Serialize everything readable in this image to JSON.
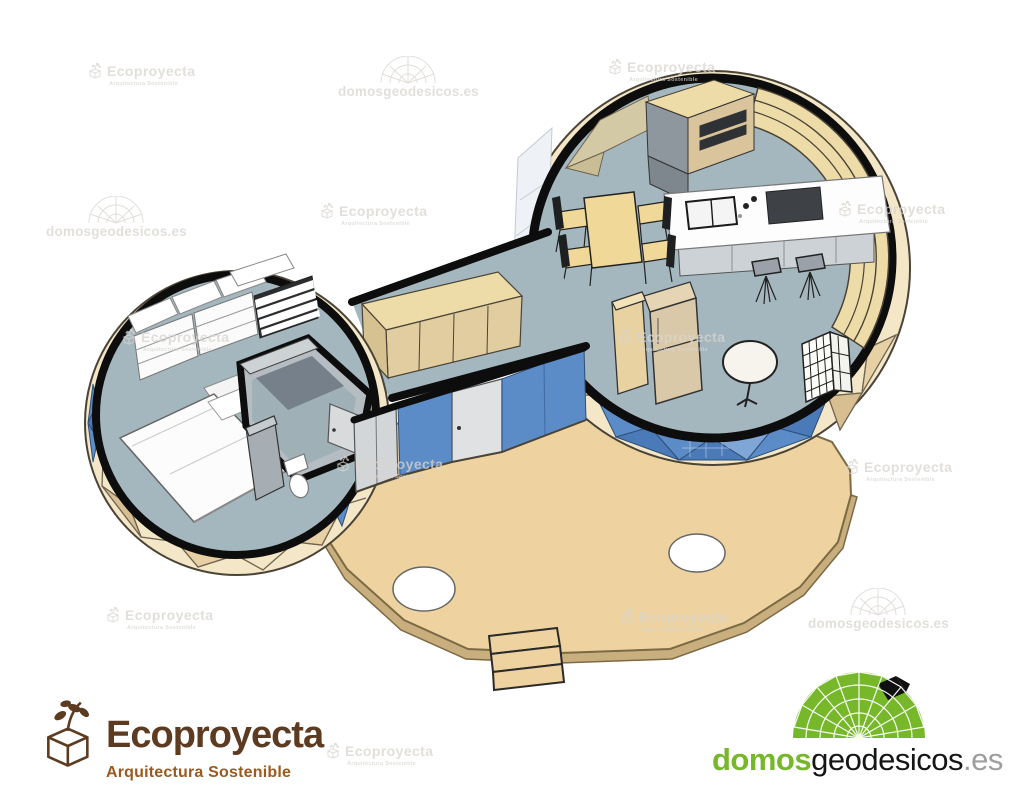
{
  "watermarks": {
    "ecoproyecta_title": "Ecoproyecta",
    "ecoproyecta_subtitle": "Arquitectura Sostenible",
    "domos_text": "domosgeodesicos.es"
  },
  "footer": {
    "eco_title": "Ecoproyecta",
    "eco_subtitle": "Arquitectura Sostenible",
    "domos_part1": "domos",
    "domos_part2": "geodesicos",
    "domos_part3": ".es"
  },
  "colors": {
    "floor": "#a4b7be",
    "shell-cream": "#f3e7c8",
    "shell-tan": "#e6d0a4",
    "shell-dark": "#d8bf92",
    "plywood": "#eedca8",
    "facet": "#6e6450",
    "outline": "#0d0d0d",
    "glass-blue": "#5c8cc7",
    "glass-blue-dark": "#4a7ab8",
    "glass-blue-light": "#7fa6d6",
    "terrace": "#eed3a0",
    "terrace-side": "#c9ae7e",
    "terrace-edge": "#7c6a45",
    "table-wood": "#f0d998",
    "appliance-dark": "#3e4246",
    "wm": "#d9d5cf",
    "eco-brown": "#5d3b20",
    "eco-orange": "#9c5a1e",
    "domo-green": "#76b82a",
    "domo-black": "#151515",
    "domo-gray": "#9e9e9e"
  }
}
